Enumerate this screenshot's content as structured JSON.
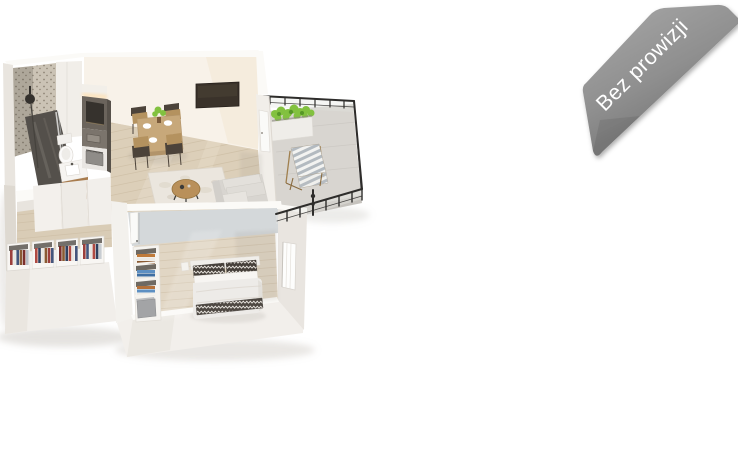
{
  "page": {
    "background": "#ffffff"
  },
  "badge": {
    "label": "Bez prowizji",
    "text_color": "#ffffff",
    "ribbon_top": "#a6a6a6",
    "ribbon_mid": "#8f8f8f",
    "ribbon_bottom": "#6c6c6c"
  },
  "floorplan": {
    "colors": {
      "wall_top": "#fbfaf7",
      "wall_white": "#f2efeb",
      "inner_wall": "#f8f2e9",
      "partition_gray": "#d4d8da",
      "floor_living": "#dccfb9",
      "floor_bedroom": "#e1d6c4",
      "floor_hall": "#d9ccb6",
      "plank_line": "#c2b196",
      "bath_wall": "#cbc3b5",
      "bath_floor": "#54504b",
      "kitchen_dark": "#6b645c",
      "kitchen_niche": "#36322d",
      "counter_gray": "#7b746c",
      "wood_accent": "#a87c4e",
      "table_wood": "#c7a87a",
      "chair_frame": "#4c433a",
      "sofa_gray": "#d8d5d0",
      "rug_cream": "#ebe6de",
      "tv_dark": "#3a322a",
      "balcony_concrete": "#d8d5d0",
      "slab_gray": "#c6c3be",
      "railing_black": "#2e2d2b",
      "planter_white": "#efede9",
      "plant_green": "#82c13f",
      "bed_white": "#edebe8",
      "pillow_dark": "#46403a",
      "shelf_blue": "#5d8fc2",
      "shelf_orange": "#bf7a3a",
      "box_gray": "#a3a4a6"
    }
  }
}
